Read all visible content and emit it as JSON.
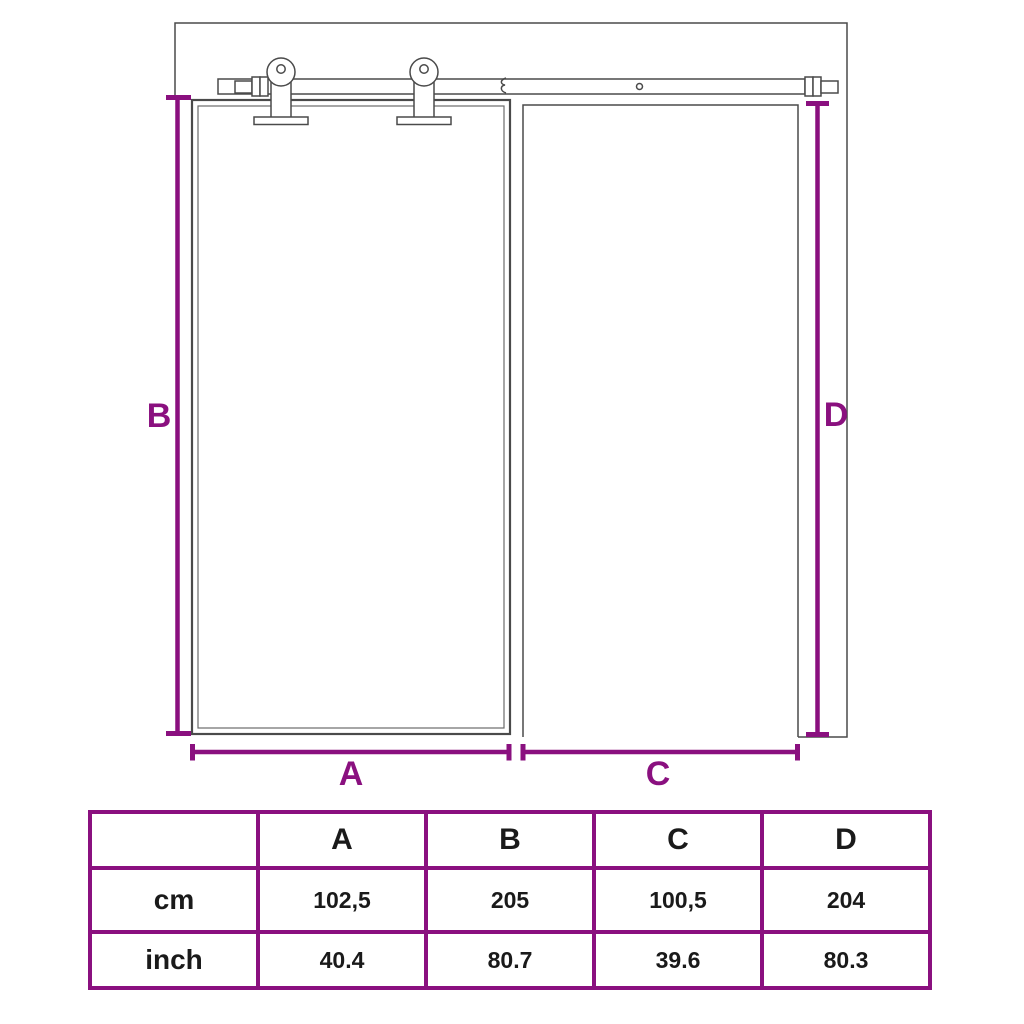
{
  "colors": {
    "accent_purple": "#8a107f",
    "drawing_line": "#4a4a4a",
    "table_text": "#1a1a1a"
  },
  "diagram": {
    "labels": {
      "a": "A",
      "b": "B",
      "c": "C",
      "d": "D"
    }
  },
  "table": {
    "columns": [
      "",
      "A",
      "B",
      "C",
      "D"
    ],
    "rows": [
      {
        "label": "cm",
        "values": [
          "102,5",
          "205",
          "100,5",
          "204"
        ]
      },
      {
        "label": "inch",
        "values": [
          "40.4",
          "80.7",
          "39.6",
          "80.3"
        ]
      }
    ]
  }
}
